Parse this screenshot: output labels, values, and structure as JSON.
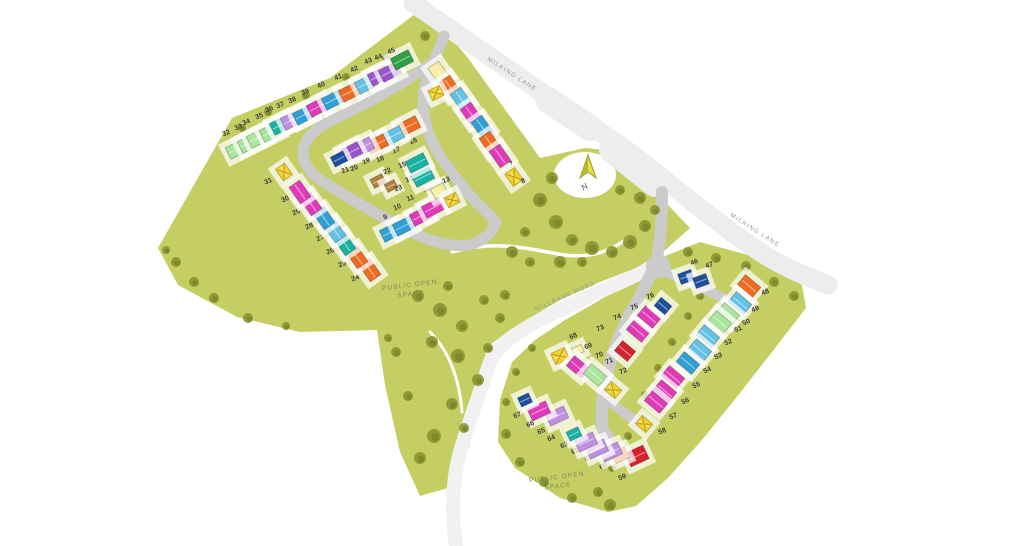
{
  "map": {
    "title": "Development site plan",
    "road_labels": [
      {
        "text": "MILKING LANE"
      },
      {
        "text": "MILKING LANE"
      },
      {
        "text": "MILLBANK ROAD"
      }
    ],
    "open_space_labels": [
      {
        "line1": "PUBLIC OPEN",
        "line2": "SPACE"
      },
      {
        "line1": "PUBLIC OPEN",
        "line2": "SPACE"
      }
    ],
    "north": {
      "label": "N"
    },
    "palette": {
      "magenta": "#e03ab8",
      "blue": "#2f9fd4",
      "lightblue": "#62c1e5",
      "darkblue": "#1c4f9e",
      "teal": "#17b2a2",
      "green": "#2f9e44",
      "lightgreen": "#a9e69b",
      "purple": "#9a55cc",
      "lightpurple": "#bf90e0",
      "orange": "#ee6b22",
      "red": "#d6222f",
      "yellow": "#f5d22c",
      "paleyellow": "#f5eda0",
      "brown": "#b2803a",
      "land": "#c4ce62",
      "tree": "#8c9330",
      "road_minor": "#cbcbcb",
      "road_major": "#ededed",
      "number_text": "#3c3c3c"
    },
    "plots": [
      {
        "n": 1,
        "x": 451,
        "y": 83,
        "hx": 439,
        "hy": 73,
        "c": "paleyellow",
        "r": 55
      },
      {
        "n": 2,
        "x": 462,
        "y": 96,
        "hx": 450,
        "hy": 87,
        "c": "orange",
        "r": 55
      },
      {
        "n": 3,
        "x": 473,
        "y": 108,
        "hx": 461,
        "hy": 99,
        "c": "lightblue",
        "r": 55
      },
      {
        "n": 4,
        "x": 483,
        "y": 124,
        "hx": 471,
        "hy": 114,
        "c": "magenta",
        "r": 55
      },
      {
        "n": 5,
        "x": 494,
        "y": 137,
        "hx": 482,
        "hy": 127,
        "c": "blue",
        "r": 55
      },
      {
        "n": 6,
        "x": 502,
        "y": 153,
        "hx": 490,
        "hy": 143,
        "c": "orange",
        "r": 55
      },
      {
        "n": 7,
        "x": 512,
        "y": 166,
        "hx": 500,
        "hy": 156,
        "c": "magenta",
        "r": 55
      },
      {
        "n": 8,
        "x": 524,
        "y": 183,
        "hx": 514,
        "hy": 177,
        "c": "yellowX",
        "r": 55,
        "w": 15,
        "h": 12
      },
      {
        "n": 9,
        "x": 386,
        "y": 219,
        "hx": 391,
        "hy": 232,
        "c": "blue",
        "r": -27
      },
      {
        "n": 10,
        "x": 398,
        "y": 209,
        "hx": 404,
        "hy": 226,
        "c": "blue",
        "r": -27
      },
      {
        "n": 11,
        "x": 411,
        "y": 200,
        "hx": 421,
        "hy": 216,
        "c": "magenta",
        "r": -27
      },
      {
        "n": 12,
        "x": 428,
        "y": 191,
        "hx": 433,
        "hy": 208,
        "c": "magenta",
        "r": -27
      },
      {
        "n": 13,
        "x": 447,
        "y": 182,
        "hx": 439,
        "hy": 191,
        "c": "paleyellow",
        "r": -27,
        "w": 14,
        "h": 11
      },
      {
        "n": 14,
        "x": 410,
        "y": 181,
        "hx": 423,
        "hy": 177,
        "c": "teal",
        "r": -27
      },
      {
        "n": 15,
        "x": 403,
        "y": 167,
        "hx": 417,
        "hy": 163,
        "c": "teal",
        "r": -27
      },
      {
        "n": 16,
        "x": 414,
        "y": 143,
        "hx": 409,
        "hy": 126,
        "c": "orange",
        "r": -27
      },
      {
        "n": 17,
        "x": 397,
        "y": 152,
        "hx": 393,
        "hy": 136,
        "c": "lightblue",
        "r": -27
      },
      {
        "n": 18,
        "x": 381,
        "y": 161,
        "hx": 377,
        "hy": 144,
        "c": "orange",
        "r": -27
      },
      {
        "n": 19,
        "x": 367,
        "y": 163,
        "hx": 363,
        "hy": 147,
        "c": "lightpurple",
        "r": -27
      },
      {
        "n": 20,
        "x": 355,
        "y": 170,
        "hx": 351,
        "hy": 152,
        "c": "purple",
        "r": -27
      },
      {
        "n": 21,
        "x": 346,
        "y": 172,
        "hx": 339,
        "hy": 159,
        "c": "darkblue",
        "r": -27,
        "w": 14,
        "h": 11
      },
      {
        "n": 22,
        "x": 388,
        "y": 173,
        "hx": 378,
        "hy": 181,
        "c": "brown",
        "r": -27,
        "w": 13,
        "h": 10
      },
      {
        "n": 23,
        "x": 399,
        "y": 190,
        "hx": 391,
        "hy": 186,
        "c": "brown",
        "r": -27,
        "w": 11,
        "h": 9
      },
      {
        "n": 24,
        "x": 356,
        "y": 280,
        "hx": 370,
        "hy": 270,
        "c": "orange",
        "r": 55
      },
      {
        "n": 25,
        "x": 343,
        "y": 266,
        "hx": 357,
        "hy": 257,
        "c": "orange",
        "r": 55
      },
      {
        "n": 26,
        "x": 331,
        "y": 253,
        "hx": 345,
        "hy": 244,
        "c": "teal",
        "r": 55
      },
      {
        "n": 27,
        "x": 321,
        "y": 240,
        "hx": 335,
        "hy": 231,
        "c": "lightblue",
        "r": 55
      },
      {
        "n": 28,
        "x": 310,
        "y": 228,
        "hx": 324,
        "hy": 218,
        "c": "blue",
        "r": 55
      },
      {
        "n": 29,
        "x": 297,
        "y": 214,
        "hx": 311,
        "hy": 204,
        "c": "magenta",
        "r": 55
      },
      {
        "n": 30,
        "x": 286,
        "y": 201,
        "hx": 300,
        "hy": 192,
        "c": "magenta",
        "r": 55
      },
      {
        "n": 31,
        "x": 269,
        "y": 183,
        "hx": 284,
        "hy": 172,
        "c": "yellowX",
        "r": 55,
        "w": 14,
        "h": 11
      },
      {
        "n": 32,
        "x": 227,
        "y": 135,
        "hx": 237,
        "hy": 149,
        "c": "lightgreen",
        "r": -27
      },
      {
        "n": 33,
        "x": 239,
        "y": 129,
        "hx": 249,
        "hy": 143,
        "c": "lightgreen",
        "r": -27
      },
      {
        "n": 34,
        "x": 247,
        "y": 124,
        "hx": 258,
        "hy": 138,
        "c": "lightgreen",
        "r": -27
      },
      {
        "n": 35,
        "x": 260,
        "y": 118,
        "hx": 271,
        "hy": 132,
        "c": "lightgreen",
        "r": -27
      },
      {
        "n": 36,
        "x": 270,
        "y": 111,
        "hx": 281,
        "hy": 125,
        "c": "teal",
        "r": -27
      },
      {
        "n": 37,
        "x": 281,
        "y": 107,
        "hx": 292,
        "hy": 120,
        "c": "lightpurple",
        "r": -27
      },
      {
        "n": 38,
        "x": 293,
        "y": 102,
        "hx": 304,
        "hy": 115,
        "c": "blue",
        "r": -27
      },
      {
        "n": 39,
        "x": 306,
        "y": 94,
        "hx": 318,
        "hy": 107,
        "c": "magenta",
        "r": -27
      },
      {
        "n": 40,
        "x": 322,
        "y": 87,
        "hx": 333,
        "hy": 100,
        "c": "blue",
        "r": -27
      },
      {
        "n": 41,
        "x": 339,
        "y": 79,
        "hx": 350,
        "hy": 92,
        "c": "orange",
        "r": -27
      },
      {
        "n": 42,
        "x": 355,
        "y": 71,
        "hx": 366,
        "hy": 84,
        "c": "lightblue",
        "r": -27
      },
      {
        "n": 43,
        "x": 369,
        "y": 63,
        "hx": 379,
        "hy": 76,
        "c": "purple",
        "r": -27
      },
      {
        "n": 44,
        "x": 379,
        "y": 59,
        "hx": 390,
        "hy": 72,
        "c": "purple",
        "r": -27
      },
      {
        "n": 45,
        "x": 392,
        "y": 53,
        "hx": 402,
        "hy": 60,
        "c": "green",
        "r": -27
      },
      {
        "n": 46,
        "x": 695,
        "y": 264,
        "hx": 686,
        "hy": 277,
        "c": "darkblue",
        "r": -20,
        "w": 14,
        "h": 11
      },
      {
        "n": 47,
        "x": 710,
        "y": 267,
        "hx": 701,
        "hy": 281,
        "c": "darkblue",
        "r": -20,
        "w": 14,
        "h": 11
      },
      {
        "n": 48,
        "x": 766,
        "y": 294,
        "hx": 749,
        "hy": 286,
        "c": "orange",
        "r": 40
      },
      {
        "n": 49,
        "x": 756,
        "y": 311,
        "hx": 740,
        "hy": 303,
        "c": "lightblue",
        "r": 40
      },
      {
        "n": 50,
        "x": 747,
        "y": 324,
        "hx": 728,
        "hy": 314,
        "c": "lightgreen",
        "r": 40
      },
      {
        "n": 51,
        "x": 739,
        "y": 331,
        "hx": 720,
        "hy": 322,
        "c": "lightgreen",
        "r": 40
      },
      {
        "n": 52,
        "x": 729,
        "y": 344,
        "hx": 708,
        "hy": 336,
        "c": "lightblue",
        "r": 40
      },
      {
        "n": 53,
        "x": 719,
        "y": 358,
        "hx": 700,
        "hy": 350,
        "c": "lightblue",
        "r": 40
      },
      {
        "n": 54,
        "x": 708,
        "y": 372,
        "hx": 688,
        "hy": 363,
        "c": "blue",
        "r": 40
      },
      {
        "n": 55,
        "x": 697,
        "y": 387,
        "hx": 673,
        "hy": 377,
        "c": "magenta",
        "r": 40
      },
      {
        "n": 56,
        "x": 686,
        "y": 403,
        "hx": 665,
        "hy": 391,
        "c": "magenta",
        "r": 40
      },
      {
        "n": 57,
        "x": 674,
        "y": 418,
        "hx": 656,
        "hy": 402,
        "c": "magenta",
        "r": 40
      },
      {
        "n": 58,
        "x": 663,
        "y": 433,
        "hx": 644,
        "hy": 424,
        "c": "yellowX",
        "r": 40,
        "w": 14,
        "h": 11
      },
      {
        "n": 59,
        "x": 623,
        "y": 479,
        "hx": 637,
        "hy": 456,
        "c": "red",
        "r": -25,
        "w": 20,
        "h": 15
      },
      {
        "n": 60,
        "x": 604,
        "y": 468,
        "hx": 620,
        "hy": 455,
        "c": "orange",
        "r": -25,
        "w": 15,
        "h": 12
      },
      {
        "n": 61,
        "x": 589,
        "y": 460,
        "hx": 611,
        "hy": 452,
        "c": "lightpurple",
        "r": -25
      },
      {
        "n": 62,
        "x": 576,
        "y": 453,
        "hx": 597,
        "hy": 449,
        "c": "lightpurple",
        "r": -25
      },
      {
        "n": 63,
        "x": 565,
        "y": 447,
        "hx": 586,
        "hy": 442,
        "c": "lightpurple",
        "r": -25
      },
      {
        "n": 64,
        "x": 552,
        "y": 440,
        "hx": 574,
        "hy": 434,
        "c": "teal",
        "r": -25,
        "w": 13,
        "h": 10
      },
      {
        "n": 65,
        "x": 542,
        "y": 433,
        "hx": 557,
        "hy": 416,
        "c": "lightpurple",
        "r": -25
      },
      {
        "n": 66,
        "x": 531,
        "y": 426,
        "hx": 539,
        "hy": 411,
        "c": "magenta",
        "r": -25
      },
      {
        "n": 67,
        "x": 518,
        "y": 417,
        "hx": 525,
        "hy": 400,
        "c": "darkblue",
        "r": -25,
        "w": 12,
        "h": 10
      },
      {
        "n": 68,
        "x": 574,
        "y": 338,
        "hx": 560,
        "hy": 356,
        "c": "yellowX",
        "r": -25,
        "w": 15,
        "h": 12
      },
      {
        "n": 69,
        "x": 589,
        "y": 348,
        "hx": 578,
        "hy": 350,
        "c": "paleyellow",
        "r": -25,
        "w": 10,
        "h": 8
      },
      {
        "n": 70,
        "x": 600,
        "y": 357,
        "hx": 578,
        "hy": 367,
        "c": "magenta",
        "r": 40
      },
      {
        "n": 71,
        "x": 610,
        "y": 363,
        "hx": 595,
        "hy": 375,
        "c": "lightgreen",
        "r": 40
      },
      {
        "n": 72,
        "x": 624,
        "y": 373,
        "hx": 613,
        "hy": 390,
        "c": "yellowX",
        "r": 40,
        "w": 14,
        "h": 11
      },
      {
        "n": 73,
        "x": 601,
        "y": 330,
        "hx": 625,
        "hy": 351,
        "c": "red",
        "r": 40,
        "w": 17,
        "h": 13
      },
      {
        "n": 74,
        "x": 618,
        "y": 319,
        "hx": 638,
        "hy": 331,
        "c": "magenta",
        "r": 40
      },
      {
        "n": 75,
        "x": 635,
        "y": 309,
        "hx": 649,
        "hy": 317,
        "c": "magenta",
        "r": 40
      },
      {
        "n": 76,
        "x": 651,
        "y": 298,
        "hx": 663,
        "hy": 306,
        "c": "darkblue",
        "r": 40,
        "w": 14,
        "h": 11
      }
    ],
    "garages": [
      {
        "x": 436,
        "y": 93,
        "r": -27
      },
      {
        "x": 452,
        "y": 200,
        "r": -27
      }
    ],
    "trees": [
      [
        552,
        178,
        6
      ],
      [
        540,
        200,
        7
      ],
      [
        556,
        222,
        7
      ],
      [
        572,
        240,
        6
      ],
      [
        592,
        248,
        7
      ],
      [
        612,
        252,
        6
      ],
      [
        630,
        242,
        7
      ],
      [
        645,
        226,
        6
      ],
      [
        655,
        210,
        5
      ],
      [
        620,
        190,
        5
      ],
      [
        640,
        198,
        6
      ],
      [
        525,
        232,
        5
      ],
      [
        512,
        252,
        6
      ],
      [
        530,
        262,
        5
      ],
      [
        560,
        262,
        6
      ],
      [
        582,
        262,
        5
      ],
      [
        418,
        296,
        6
      ],
      [
        440,
        310,
        7
      ],
      [
        462,
        326,
        6
      ],
      [
        484,
        300,
        5
      ],
      [
        500,
        318,
        5
      ],
      [
        448,
        286,
        5
      ],
      [
        432,
        342,
        6
      ],
      [
        458,
        356,
        7
      ],
      [
        478,
        380,
        6
      ],
      [
        452,
        404,
        6
      ],
      [
        434,
        436,
        7
      ],
      [
        464,
        428,
        5
      ],
      [
        488,
        348,
        5
      ],
      [
        505,
        295,
        5
      ],
      [
        242,
        128,
        4
      ],
      [
        268,
        112,
        4
      ],
      [
        306,
        96,
        4
      ],
      [
        346,
        77,
        4
      ],
      [
        386,
        58,
        4
      ],
      [
        425,
        36,
        5
      ],
      [
        176,
        262,
        5
      ],
      [
        194,
        282,
        5
      ],
      [
        214,
        298,
        5
      ],
      [
        248,
        318,
        5
      ],
      [
        286,
        326,
        4
      ],
      [
        166,
        250,
        4
      ],
      [
        396,
        352,
        5
      ],
      [
        408,
        396,
        5
      ],
      [
        420,
        458,
        6
      ],
      [
        388,
        338,
        4
      ],
      [
        688,
        252,
        5
      ],
      [
        716,
        258,
        5
      ],
      [
        746,
        266,
        5
      ],
      [
        774,
        282,
        5
      ],
      [
        794,
        296,
        5
      ],
      [
        700,
        296,
        4
      ],
      [
        688,
        316,
        4
      ],
      [
        672,
        342,
        4
      ],
      [
        658,
        368,
        4
      ],
      [
        645,
        395,
        4
      ],
      [
        628,
        436,
        4
      ],
      [
        612,
        468,
        4
      ],
      [
        598,
        492,
        5
      ],
      [
        572,
        498,
        5
      ],
      [
        544,
        482,
        5
      ],
      [
        520,
        462,
        5
      ],
      [
        506,
        434,
        5
      ],
      [
        506,
        402,
        4
      ],
      [
        516,
        372,
        4
      ],
      [
        532,
        348,
        4
      ],
      [
        610,
        505,
        6
      ]
    ]
  }
}
